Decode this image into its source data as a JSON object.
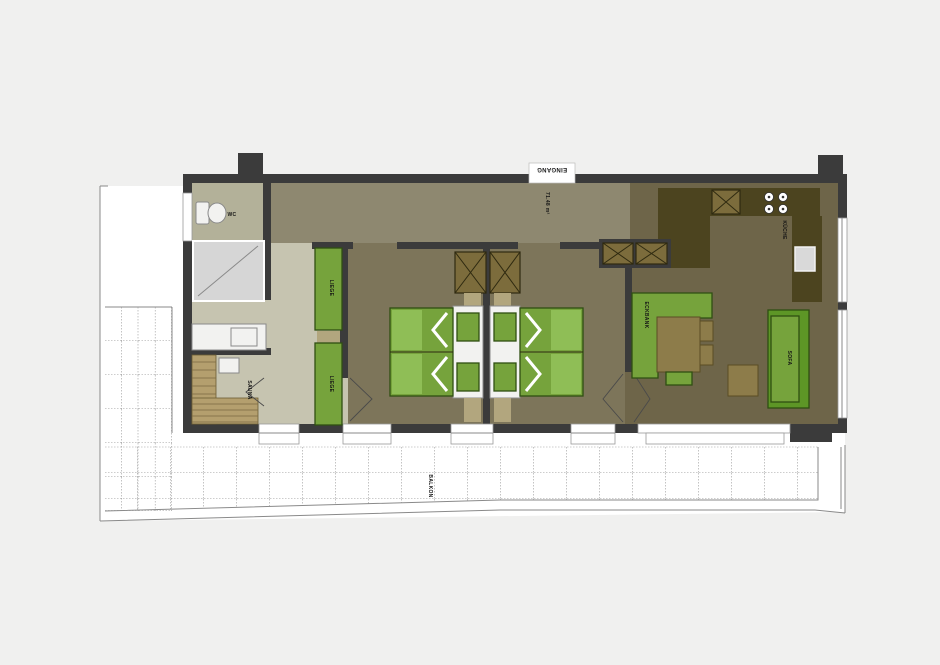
{
  "labels": {
    "entrance": "EINGANG",
    "area": "71.48 m²",
    "wc": "WC",
    "sauna": "SAUNA",
    "lounger1": "LIEGE",
    "lounger2": "LIEGE",
    "kitchen": "KÜCHE",
    "corner_bench": "ECKBANK",
    "sofa": "SOFA",
    "balcony": "BALKON"
  },
  "colors": {
    "background": "#f0f0ef",
    "wall": "#3b3b3b",
    "floorHall": "#8e8870",
    "floorBedroom": "#7d755a",
    "floorLiving": "#6e6549",
    "floorBath": "#c6c4b0",
    "floorWc": "#b3b199",
    "kitchenCounter": "#4c441f",
    "cabinet": "#7c6c3c",
    "furnitureGreen": "#76a33c",
    "furnitureGreenDark": "#5d9626",
    "furnitureGreenLight": "#8fbe56",
    "saunaWood": "#b49f6e",
    "tan": "#b2a67e",
    "tableBrown": "#8d7c4a",
    "shower": "#d6d6d6",
    "outline": "#2f4f12"
  }
}
